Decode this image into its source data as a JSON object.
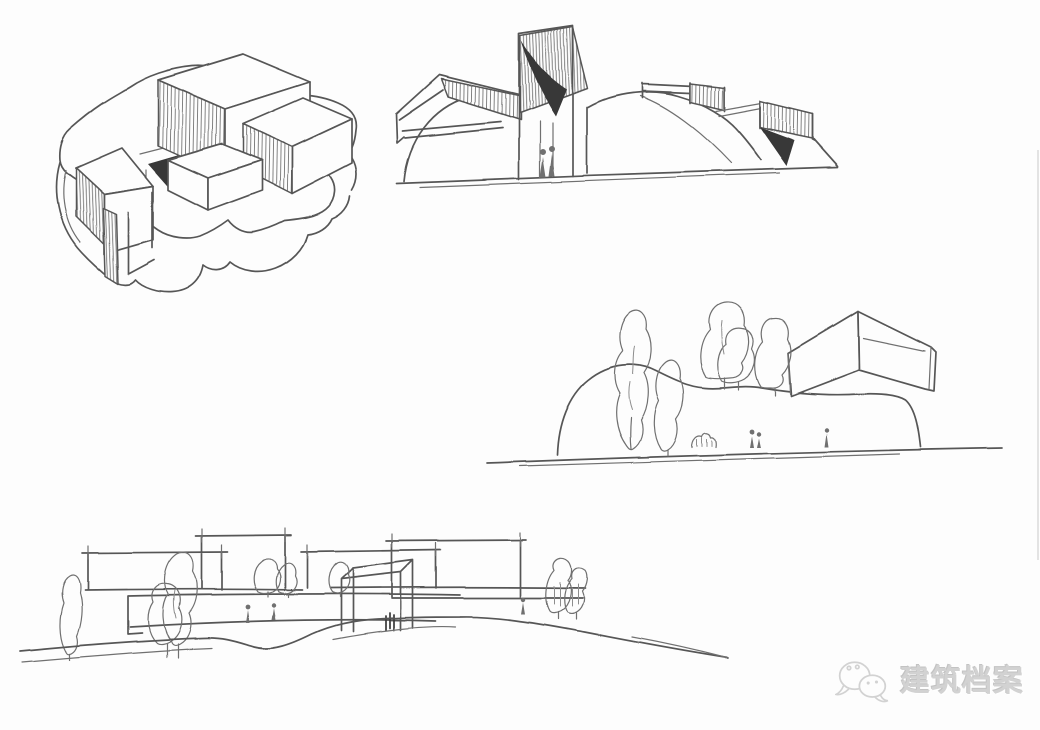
{
  "theme": {
    "paper": "#fdfdfd",
    "ink": "#575757",
    "ink2": "#6f6f6f",
    "ink3": "#8d8d8d",
    "hatch": "#6e6e6e",
    "shade": "#373737",
    "figure": "#6f6f6f",
    "wm": "#d2d2d2",
    "edge": "#c9c9c9"
  },
  "watermark": {
    "icon": "wechat-chat-bubbles",
    "text": "建筑档案"
  }
}
